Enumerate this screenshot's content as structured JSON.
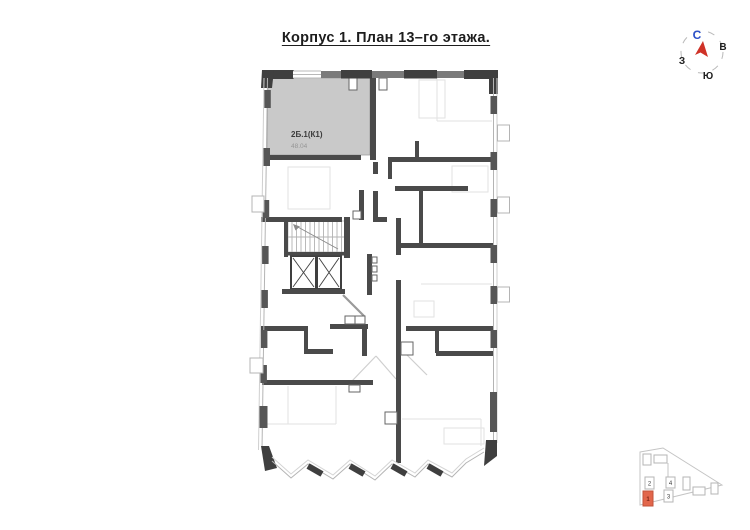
{
  "title": "Корпус 1. План 13–го этажа.",
  "compass": {
    "north": "С",
    "east": "В",
    "west": "З",
    "south": "Ю",
    "north_color": "#2b50c8",
    "arrow_color": "#cf3227"
  },
  "floorplan": {
    "apartment": {
      "id": "2Б.1(К1)",
      "area": "48.04",
      "fill": "#c9c9c9"
    }
  },
  "minimap": {
    "highlight_color": "#e2664b",
    "buildings": [
      {
        "label": "1",
        "highlighted": true
      },
      {
        "label": "2",
        "highlighted": false
      },
      {
        "label": "3",
        "highlighted": false
      },
      {
        "label": "4",
        "highlighted": false
      }
    ]
  }
}
